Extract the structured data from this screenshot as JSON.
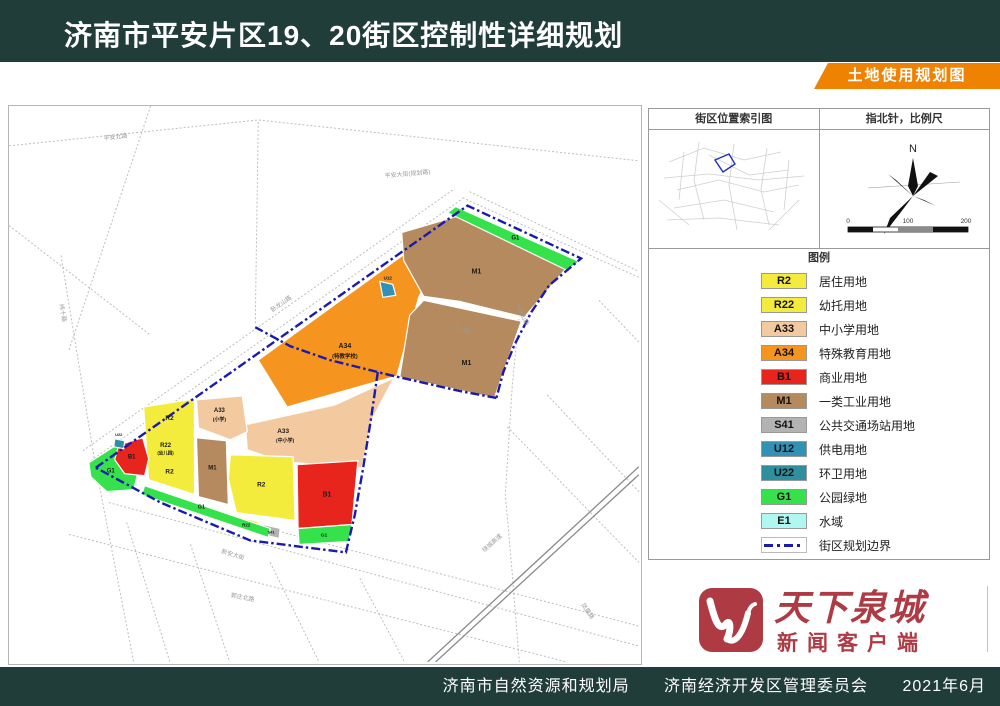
{
  "header": {
    "title": "济南市平安片区19、20街区控制性详细规划",
    "banner": "土地使用规划图"
  },
  "panel": {
    "index_map_title": "街区位置索引图",
    "compass_title": "指北针，比例尺",
    "compass_n": "N",
    "legend_title": "图例",
    "scale_ticks": [
      "0",
      "100",
      "200"
    ],
    "legend": [
      {
        "code": "R2",
        "label": "居住用地",
        "color": "#f4ec3c"
      },
      {
        "code": "R22",
        "label": "幼托用地",
        "color": "#f4ec3c"
      },
      {
        "code": "A33",
        "label": "中小学用地",
        "color": "#f3c9a0"
      },
      {
        "code": "A34",
        "label": "特殊教育用地",
        "color": "#f5941f"
      },
      {
        "code": "B1",
        "label": "商业用地",
        "color": "#e8251d"
      },
      {
        "code": "M1",
        "label": "一类工业用地",
        "color": "#b58a5f"
      },
      {
        "code": "S41",
        "label": "公共交通场站用地",
        "color": "#b3b3b3"
      },
      {
        "code": "U12",
        "label": "供电用地",
        "color": "#3192b5"
      },
      {
        "code": "U22",
        "label": "环卫用地",
        "color": "#2f8f9f"
      },
      {
        "code": "G1",
        "label": "公园绿地",
        "color": "#35e24b"
      },
      {
        "code": "E1",
        "label": "水域",
        "color": "#aff7f0"
      },
      {
        "code": "BOUNDARY",
        "label": "街区规划边界",
        "type": "dash",
        "color": "#1a1aae"
      }
    ]
  },
  "map": {
    "boundary_color": "#1a1aae",
    "boundary_paths": [
      [
        [
          87,
          363
        ],
        [
          460,
          100
        ],
        [
          574,
          153
        ],
        [
          542,
          180
        ],
        [
          524,
          207
        ],
        [
          507,
          240
        ],
        [
          496,
          267
        ],
        [
          489,
          293
        ]
      ],
      [
        [
          489,
          293
        ],
        [
          452,
          286
        ],
        [
          382,
          270
        ],
        [
          322,
          255
        ],
        [
          282,
          241
        ],
        [
          247,
          222
        ]
      ],
      [
        [
          370,
          267
        ],
        [
          363,
          315
        ],
        [
          355,
          365
        ],
        [
          347,
          410
        ],
        [
          338,
          448
        ],
        [
          242,
          436
        ],
        [
          152,
          398
        ],
        [
          87,
          363
        ]
      ]
    ],
    "roads": [
      {
        "pts": [
          [
            0,
            40
          ],
          [
            250,
            14
          ],
          [
            632,
            55
          ]
        ]
      },
      {
        "pts": [
          [
            82,
            356
          ],
          [
            455,
            93
          ]
        ]
      },
      {
        "pts": [
          [
            74,
            346
          ],
          [
            447,
            83
          ]
        ]
      },
      {
        "pts": [
          [
            52,
            150
          ],
          [
            87,
            363
          ],
          [
            125,
            558
          ]
        ]
      },
      {
        "pts": [
          [
            142,
            0
          ],
          [
            60,
            245
          ]
        ]
      },
      {
        "pts": [
          [
            0,
            120
          ],
          [
            142,
            230
          ]
        ]
      },
      {
        "pts": [
          [
            250,
            16
          ],
          [
            247,
            220
          ]
        ]
      },
      {
        "pts": [
          [
            455,
            92
          ],
          [
            632,
            172
          ]
        ]
      },
      {
        "pts": [
          [
            462,
            86
          ],
          [
            632,
            166
          ]
        ]
      },
      {
        "pts": [
          [
            100,
            398
          ],
          [
            632,
            542
          ]
        ]
      },
      {
        "pts": [
          [
            150,
            395
          ],
          [
            632,
            522
          ]
        ]
      },
      {
        "pts": [
          [
            60,
            430
          ],
          [
            560,
            558
          ]
        ]
      },
      {
        "pts": [
          [
            182,
            440
          ],
          [
            222,
            560
          ]
        ]
      },
      {
        "pts": [
          [
            262,
            458
          ],
          [
            312,
            560
          ]
        ]
      },
      {
        "pts": [
          [
            352,
            474
          ],
          [
            398,
            560
          ]
        ]
      },
      {
        "pts": [
          [
            118,
            418
          ],
          [
            162,
            560
          ]
        ]
      },
      {
        "pts": [
          [
            592,
            195
          ],
          [
            632,
            237
          ]
        ]
      },
      {
        "pts": [
          [
            540,
            290
          ],
          [
            632,
            387
          ]
        ]
      },
      {
        "pts": [
          [
            500,
            322
          ],
          [
            632,
            458
          ]
        ]
      },
      {
        "pts": [
          [
            518,
            150
          ],
          [
            505,
            280
          ],
          [
            498,
            390
          ],
          [
            505,
            470
          ],
          [
            512,
            558
          ]
        ]
      },
      {
        "pts": [
          [
            420,
            558
          ],
          [
            632,
            362
          ]
        ],
        "major": true
      },
      {
        "pts": [
          [
            428,
            558
          ],
          [
            632,
            370
          ]
        ],
        "major": true
      }
    ],
    "parcels": [
      {
        "code": "A34",
        "color": "#f5941f",
        "pts": [
          [
            454,
            107
          ],
          [
            411,
            192
          ],
          [
            389,
            271
          ],
          [
            279,
            302
          ],
          [
            250,
            255
          ]
        ]
      },
      {
        "code": "M1",
        "color": "#b58a5f",
        "pts": [
          [
            394,
            127
          ],
          [
            459,
            108
          ],
          [
            564,
            157
          ],
          [
            517,
            212
          ],
          [
            452,
            196
          ],
          [
            416,
            191
          ],
          [
            396,
            155
          ]
        ]
      },
      {
        "code": "G1",
        "color": "#35e24b",
        "pts": [
          [
            448,
            101
          ],
          [
            572,
            156
          ],
          [
            560,
            165
          ],
          [
            440,
            107
          ]
        ]
      },
      {
        "code": "M1",
        "color": "#b58a5f",
        "pts": [
          [
            416,
            195
          ],
          [
            514,
            216
          ],
          [
            487,
            293
          ],
          [
            392,
            272
          ],
          [
            402,
            210
          ]
        ]
      },
      {
        "code": "U12",
        "color": "#3192b5",
        "pts": [
          [
            372,
            176
          ],
          [
            385,
            179
          ],
          [
            388,
            190
          ],
          [
            375,
            192
          ]
        ]
      },
      {
        "code": "A33",
        "color": "#f3c9a0",
        "pts": [
          [
            237,
            320
          ],
          [
            327,
            300
          ],
          [
            386,
            273
          ],
          [
            364,
            315
          ],
          [
            354,
            363
          ],
          [
            274,
            357
          ],
          [
            239,
            345
          ]
        ]
      },
      {
        "code": "A33",
        "color": "#f3c9a0",
        "pts": [
          [
            188,
            295
          ],
          [
            234,
            291
          ],
          [
            239,
            327
          ],
          [
            222,
            335
          ],
          [
            190,
            323
          ]
        ]
      },
      {
        "code": "R2",
        "color": "#f4ec3c",
        "pts": [
          [
            135,
            302
          ],
          [
            186,
            294
          ],
          [
            186,
            390
          ],
          [
            140,
            375
          ]
        ]
      },
      {
        "code": "M1",
        "color": "#b58a5f",
        "pts": [
          [
            188,
            333
          ],
          [
            218,
            336
          ],
          [
            220,
            400
          ],
          [
            190,
            392
          ]
        ]
      },
      {
        "code": "R2",
        "color": "#f4ec3c",
        "pts": [
          [
            222,
            350
          ],
          [
            285,
            352
          ],
          [
            287,
            416
          ],
          [
            228,
            408
          ],
          [
            220,
            374
          ]
        ]
      },
      {
        "code": "R22",
        "color": "#f4ec3c",
        "pts": [
          [
            228,
            412
          ],
          [
            250,
            417
          ],
          [
            249,
            428
          ],
          [
            227,
            423
          ]
        ]
      },
      {
        "code": "S41",
        "color": "#b3b3b3",
        "pts": [
          [
            255,
            420
          ],
          [
            272,
            424
          ],
          [
            271,
            434
          ],
          [
            254,
            430
          ]
        ]
      },
      {
        "code": "G1",
        "color": "#35e24b",
        "pts": [
          [
            136,
            381
          ],
          [
            262,
            424
          ],
          [
            260,
            433
          ],
          [
            133,
            390
          ]
        ]
      },
      {
        "code": "B1",
        "color": "#e8251d",
        "pts": [
          [
            289,
            360
          ],
          [
            350,
            356
          ],
          [
            344,
            420
          ],
          [
            290,
            424
          ]
        ]
      },
      {
        "code": "G1",
        "color": "#35e24b",
        "pts": [
          [
            290,
            424
          ],
          [
            344,
            420
          ],
          [
            341,
            437
          ],
          [
            291,
            440
          ]
        ]
      },
      {
        "code": "G1",
        "color": "#35e24b",
        "pts": [
          [
            80,
            358
          ],
          [
            108,
            340
          ],
          [
            130,
            365
          ],
          [
            125,
            385
          ],
          [
            98,
            387
          ],
          [
            82,
            372
          ]
        ]
      },
      {
        "code": "B1",
        "color": "#e8251d",
        "pts": [
          [
            110,
            340
          ],
          [
            134,
            333
          ],
          [
            140,
            354
          ],
          [
            136,
            371
          ],
          [
            116,
            369
          ],
          [
            106,
            355
          ]
        ]
      },
      {
        "code": "U22",
        "color": "#2f8f9f",
        "pts": [
          [
            106,
            334
          ],
          [
            116,
            336
          ],
          [
            115,
            344
          ],
          [
            105,
            342
          ]
        ]
      }
    ],
    "labels": [
      {
        "t": "M1",
        "x": 469,
        "y": 168,
        "s": 7
      },
      {
        "t": "M1",
        "x": 459,
        "y": 260,
        "s": 7
      },
      {
        "t": "G1",
        "x": 508,
        "y": 134,
        "s": 6
      },
      {
        "t": "A34",
        "x": 337,
        "y": 243,
        "s": 7
      },
      {
        "t": "(特教学校)",
        "x": 337,
        "y": 253,
        "s": 5.5
      },
      {
        "t": "U12",
        "x": 380,
        "y": 174,
        "s": 4.5
      },
      {
        "t": "A33",
        "x": 275,
        "y": 328,
        "s": 6.5
      },
      {
        "t": "(中小学)",
        "x": 277,
        "y": 337,
        "s": 5
      },
      {
        "t": "A33",
        "x": 211,
        "y": 307,
        "s": 6
      },
      {
        "t": "(小学)",
        "x": 211,
        "y": 316,
        "s": 5
      },
      {
        "t": "R2",
        "x": 161,
        "y": 315,
        "s": 6.5
      },
      {
        "t": "R22",
        "x": 157,
        "y": 342,
        "s": 6
      },
      {
        "t": "(幼儿园)",
        "x": 157,
        "y": 350,
        "s": 4.5
      },
      {
        "t": "R2",
        "x": 161,
        "y": 369,
        "s": 6.5
      },
      {
        "t": "M1",
        "x": 204,
        "y": 365,
        "s": 6
      },
      {
        "t": "R2",
        "x": 253,
        "y": 382,
        "s": 6.5
      },
      {
        "t": "R22",
        "x": 238,
        "y": 422,
        "s": 4.5
      },
      {
        "t": "S41",
        "x": 263,
        "y": 429,
        "s": 4
      },
      {
        "t": "G1",
        "x": 193,
        "y": 404,
        "s": 5.5
      },
      {
        "t": "B1",
        "x": 319,
        "y": 392,
        "s": 7
      },
      {
        "t": "G1",
        "x": 316,
        "y": 432,
        "s": 5
      },
      {
        "t": "G1",
        "x": 102,
        "y": 368,
        "s": 6
      },
      {
        "t": "B1",
        "x": 123,
        "y": 354,
        "s": 6
      },
      {
        "t": "U22",
        "x": 110,
        "y": 331,
        "s": 4
      }
    ],
    "road_labels": [
      {
        "t": "平安北路",
        "x": 107,
        "y": 33,
        "r": -7
      },
      {
        "t": "平安大街(规划路)",
        "x": 400,
        "y": 70,
        "r": -5
      },
      {
        "t": "卧龙山路",
        "x": 274,
        "y": 200,
        "r": -35
      },
      {
        "t": "大魏山路",
        "x": 513,
        "y": 210,
        "r": 62
      },
      {
        "t": "门一路",
        "x": 453,
        "y": 226,
        "r": 14
      },
      {
        "t": "新安大街",
        "x": 224,
        "y": 452,
        "r": 17
      },
      {
        "t": "绕城高速",
        "x": 486,
        "y": 440,
        "r": -42
      },
      {
        "t": "郭庄北路",
        "x": 234,
        "y": 495,
        "r": 11
      },
      {
        "t": "凤凰路",
        "x": 579,
        "y": 508,
        "r": 55
      },
      {
        "t": "纬十路",
        "x": 52,
        "y": 208,
        "r": 80
      }
    ]
  },
  "logo": {
    "title": "天下泉城",
    "subtitle": "新闻客户端"
  },
  "footer": {
    "agency_left": "济南市自然资源和规划局",
    "agency_right": "济南经济开发区管理委员会",
    "date": "2021年6月"
  }
}
